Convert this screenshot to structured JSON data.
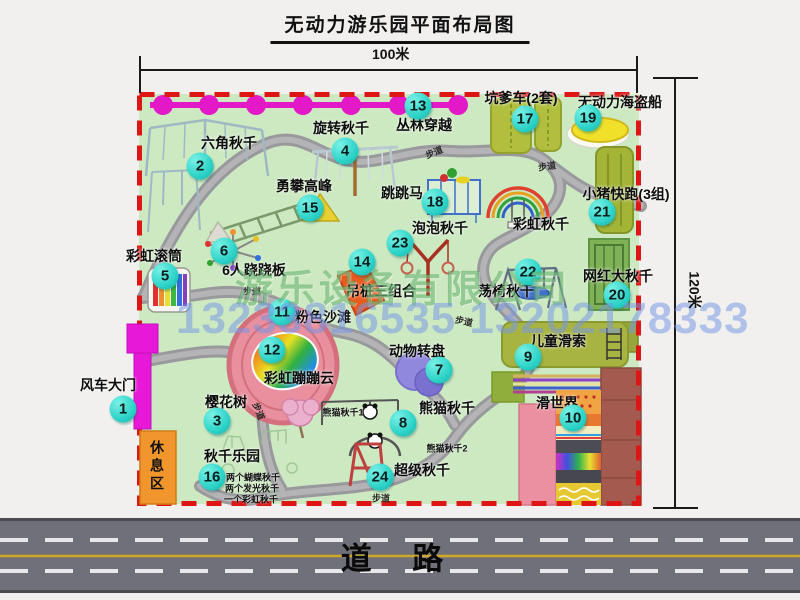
{
  "title": "无动力游乐园平面布局图",
  "dimensions": {
    "width_label": "100米",
    "height_label": "120米"
  },
  "road_label": "道  路",
  "rest_area_label": "休息区",
  "watermark": {
    "company": "游乐设备有限公司",
    "phone": "13233816535 13202178333"
  },
  "colors": {
    "park_fill": "#cde9c2",
    "border_dashed": "#dd1515",
    "marker_cyan": "#2ed3c8",
    "jungle_line": "#e318c6",
    "path_gray": "#a5a5a8",
    "road_gray": "#70707a",
    "road_yellow": "#d0a828",
    "rest_area_orange": "#f0962c",
    "gate_magenta": "#e818d8"
  },
  "attractions": [
    {
      "num": "1",
      "name": "风车大门",
      "cx": 123,
      "cy": 409,
      "lx": 108,
      "ly": 385
    },
    {
      "num": "2",
      "name": "六角秋千",
      "cx": 200,
      "cy": 166,
      "lx": 229,
      "ly": 143
    },
    {
      "num": "3",
      "name": "樱花树",
      "cx": 217,
      "cy": 421,
      "lx": 226,
      "ly": 402
    },
    {
      "num": "4",
      "name": "旋转秋千",
      "cx": 345,
      "cy": 151,
      "lx": 341,
      "ly": 128
    },
    {
      "num": "5",
      "name": "彩虹滚筒",
      "cx": 165,
      "cy": 276,
      "lx": 154,
      "ly": 256
    },
    {
      "num": "6",
      "name": "6人跷跷板",
      "cx": 224,
      "cy": 251,
      "lx": 254,
      "ly": 270
    },
    {
      "num": "7",
      "name": "动物转盘",
      "cx": 439,
      "cy": 370,
      "lx": 417,
      "ly": 351
    },
    {
      "num": "8",
      "name": "熊猫秋千",
      "cx": 403,
      "cy": 423,
      "lx": 447,
      "ly": 408,
      "subs": [
        {
          "text": "熊猫秋千1",
          "x": 343,
          "y": 412
        },
        {
          "text": "熊猫秋千2",
          "x": 447,
          "y": 448
        }
      ]
    },
    {
      "num": "9",
      "name": "儿童滑索",
      "cx": 528,
      "cy": 357,
      "lx": 558,
      "ly": 341
    },
    {
      "num": "10",
      "name": "滑世界",
      "cx": 573,
      "cy": 418,
      "lx": 557,
      "ly": 403
    },
    {
      "num": "11",
      "name": "粉色沙滩",
      "cx": 282,
      "cy": 312,
      "lx": 323,
      "ly": 317
    },
    {
      "num": "12",
      "name": "彩虹蹦蹦云",
      "cx": 272,
      "cy": 350,
      "lx": 299,
      "ly": 378
    },
    {
      "num": "13",
      "name": "丛林穿越",
      "cx": 418,
      "cy": 106,
      "lx": 424,
      "ly": 125
    },
    {
      "num": "14",
      "name": "吊桩三组合",
      "cx": 362,
      "cy": 262,
      "lx": 381,
      "ly": 291
    },
    {
      "num": "15",
      "name": "勇攀高峰",
      "cx": 310,
      "cy": 208,
      "lx": 304,
      "ly": 186
    },
    {
      "num": "16",
      "name": "秋千乐园",
      "cx": 212,
      "cy": 477,
      "lx": 232,
      "ly": 456,
      "subs": [
        {
          "text": "两个蝴蝶秋千",
          "x": 253,
          "y": 477
        },
        {
          "text": "两个发光秋千",
          "x": 252,
          "y": 488
        },
        {
          "text": "一个彩虹秋千",
          "x": 251,
          "y": 499
        }
      ]
    },
    {
      "num": "17",
      "name": "坑爹车(2套)",
      "cx": 525,
      "cy": 119,
      "lx": 521,
      "ly": 98
    },
    {
      "num": "18",
      "name": "跳跳马",
      "cx": 435,
      "cy": 202,
      "lx": 402,
      "ly": 193
    },
    {
      "num": "19",
      "name": "无动力海盗船",
      "cx": 588,
      "cy": 118,
      "lx": 620,
      "ly": 102
    },
    {
      "num": "20",
      "name": "网红大秋千",
      "cx": 617,
      "cy": 295,
      "lx": 618,
      "ly": 276
    },
    {
      "num": "21",
      "name": "小猪快跑(3组)",
      "cx": 602,
      "cy": 212,
      "lx": 626,
      "ly": 194
    },
    {
      "num": "22",
      "name": "荡椅秋千",
      "cx": 528,
      "cy": 272,
      "lx": 506,
      "ly": 291
    },
    {
      "num": "23",
      "name": "泡泡秋千",
      "cx": 400,
      "cy": 243,
      "lx": 440,
      "ly": 228
    },
    {
      "num": "24",
      "name": "超级秋千",
      "cx": 380,
      "cy": 477,
      "lx": 422,
      "ly": 470
    },
    {
      "num": null,
      "name": "彩虹秋千",
      "cx": null,
      "cy": null,
      "lx": 541,
      "ly": 224
    }
  ],
  "walkway_labels": [
    {
      "text": "步道",
      "x": 434,
      "y": 152,
      "rot": -22
    },
    {
      "text": "步道",
      "x": 547,
      "y": 166,
      "rot": -8
    },
    {
      "text": "步道",
      "x": 252,
      "y": 291,
      "rot": 0
    },
    {
      "text": "步道",
      "x": 464,
      "y": 321,
      "rot": 12
    },
    {
      "text": "步道",
      "x": 259,
      "y": 411,
      "rot": 68
    },
    {
      "text": "步道",
      "x": 381,
      "y": 498,
      "rot": 0
    }
  ]
}
